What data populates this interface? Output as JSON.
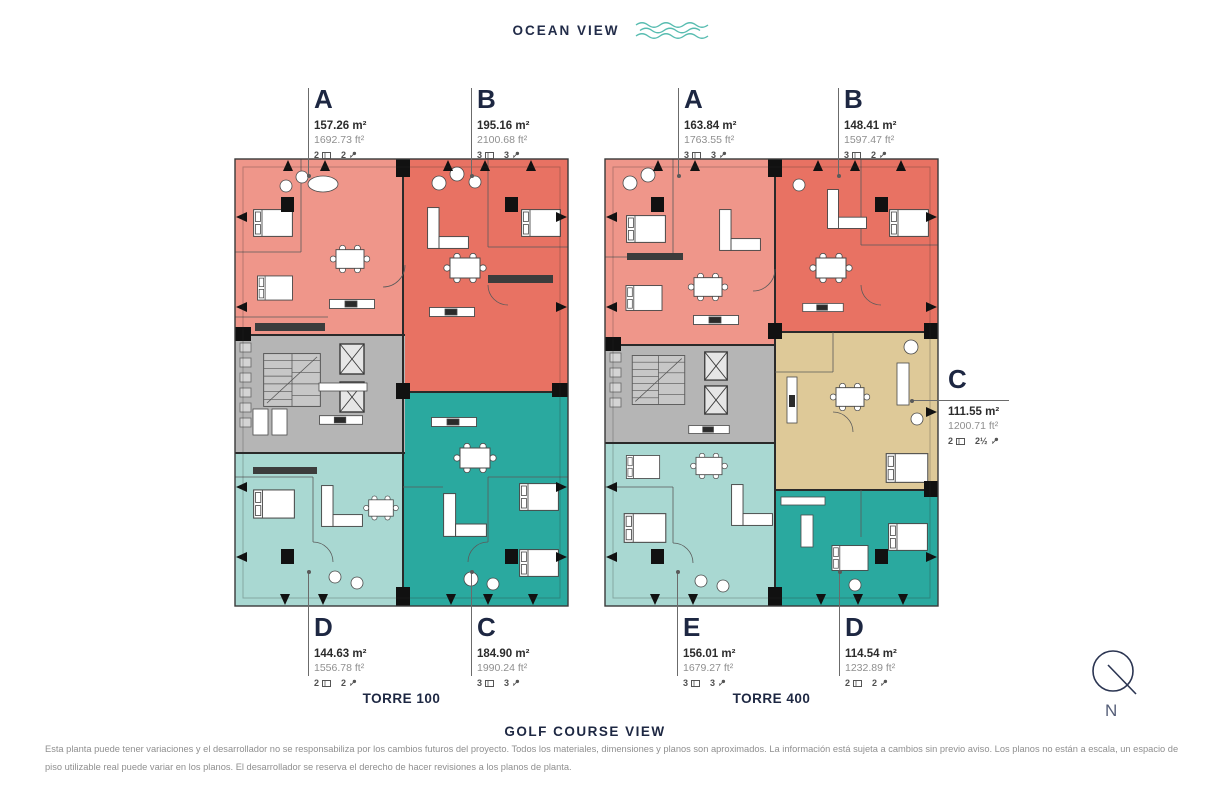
{
  "header": {
    "ocean_view": "OCEAN VIEW"
  },
  "golf_view": "GOLF COURSE VIEW",
  "towers": [
    {
      "name": "TORRE 100",
      "units": [
        {
          "letter": "A",
          "area_m2": "157.26 m²",
          "area_ft2": "1692.73 ft²",
          "beds": "2",
          "baths": "2"
        },
        {
          "letter": "B",
          "area_m2": "195.16 m²",
          "area_ft2": "2100.68 ft²",
          "beds": "3",
          "baths": "3"
        },
        {
          "letter": "D",
          "area_m2": "144.63 m²",
          "area_ft2": "1556.78 ft²",
          "beds": "2",
          "baths": "2"
        },
        {
          "letter": "C",
          "area_m2": "184.90 m²",
          "area_ft2": "1990.24 ft²",
          "beds": "3",
          "baths": "3"
        }
      ]
    },
    {
      "name": "TORRE 400",
      "units": [
        {
          "letter": "A",
          "area_m2": "163.84 m²",
          "area_ft2": "1763.55 ft²",
          "beds": "3",
          "baths": "3"
        },
        {
          "letter": "B",
          "area_m2": "148.41 m²",
          "area_ft2": "1597.47 ft²",
          "beds": "3",
          "baths": "2"
        },
        {
          "letter": "E",
          "area_m2": "156.01 m²",
          "area_ft2": "1679.27 ft²",
          "beds": "3",
          "baths": "3"
        },
        {
          "letter": "D",
          "area_m2": "114.54 m²",
          "area_ft2": "1232.89 ft²",
          "beds": "2",
          "baths": "2"
        },
        {
          "letter": "C",
          "area_m2": "111.55 m²",
          "area_ft2": "1200.71 ft²",
          "beds": "2",
          "baths": "2½"
        }
      ]
    }
  ],
  "compass": {
    "label": "N"
  },
  "disclaimer": {
    "text": "Esta planta puede tener variaciones y el desarrollador no se responsabiliza por los cambios futuros del proyecto. Todos los materiales, dimensiones y planos son aproximados. La información está sujeta a cambios sin previo aviso. Los planos no están a escala, un espacio de piso utilizable real puede variar en los planos. El desarrollador se reserva el derecho de hacer revisiones a los planos de planta."
  },
  "icons": {
    "waves": "wave-icon",
    "bed": "bed-icon",
    "bath": "bath-icon",
    "compass": "north-compass-icon"
  },
  "colors": {
    "accent_navy": "#222C49",
    "wave_teal": "#57BCB0",
    "unit_salmon_light": "#EF968A",
    "unit_coral": "#E87263",
    "unit_teal_light": "#A9D8D2",
    "unit_teal": "#2AA99F",
    "unit_tan": "#DEC998",
    "core_gray": "#B5B5B5"
  }
}
